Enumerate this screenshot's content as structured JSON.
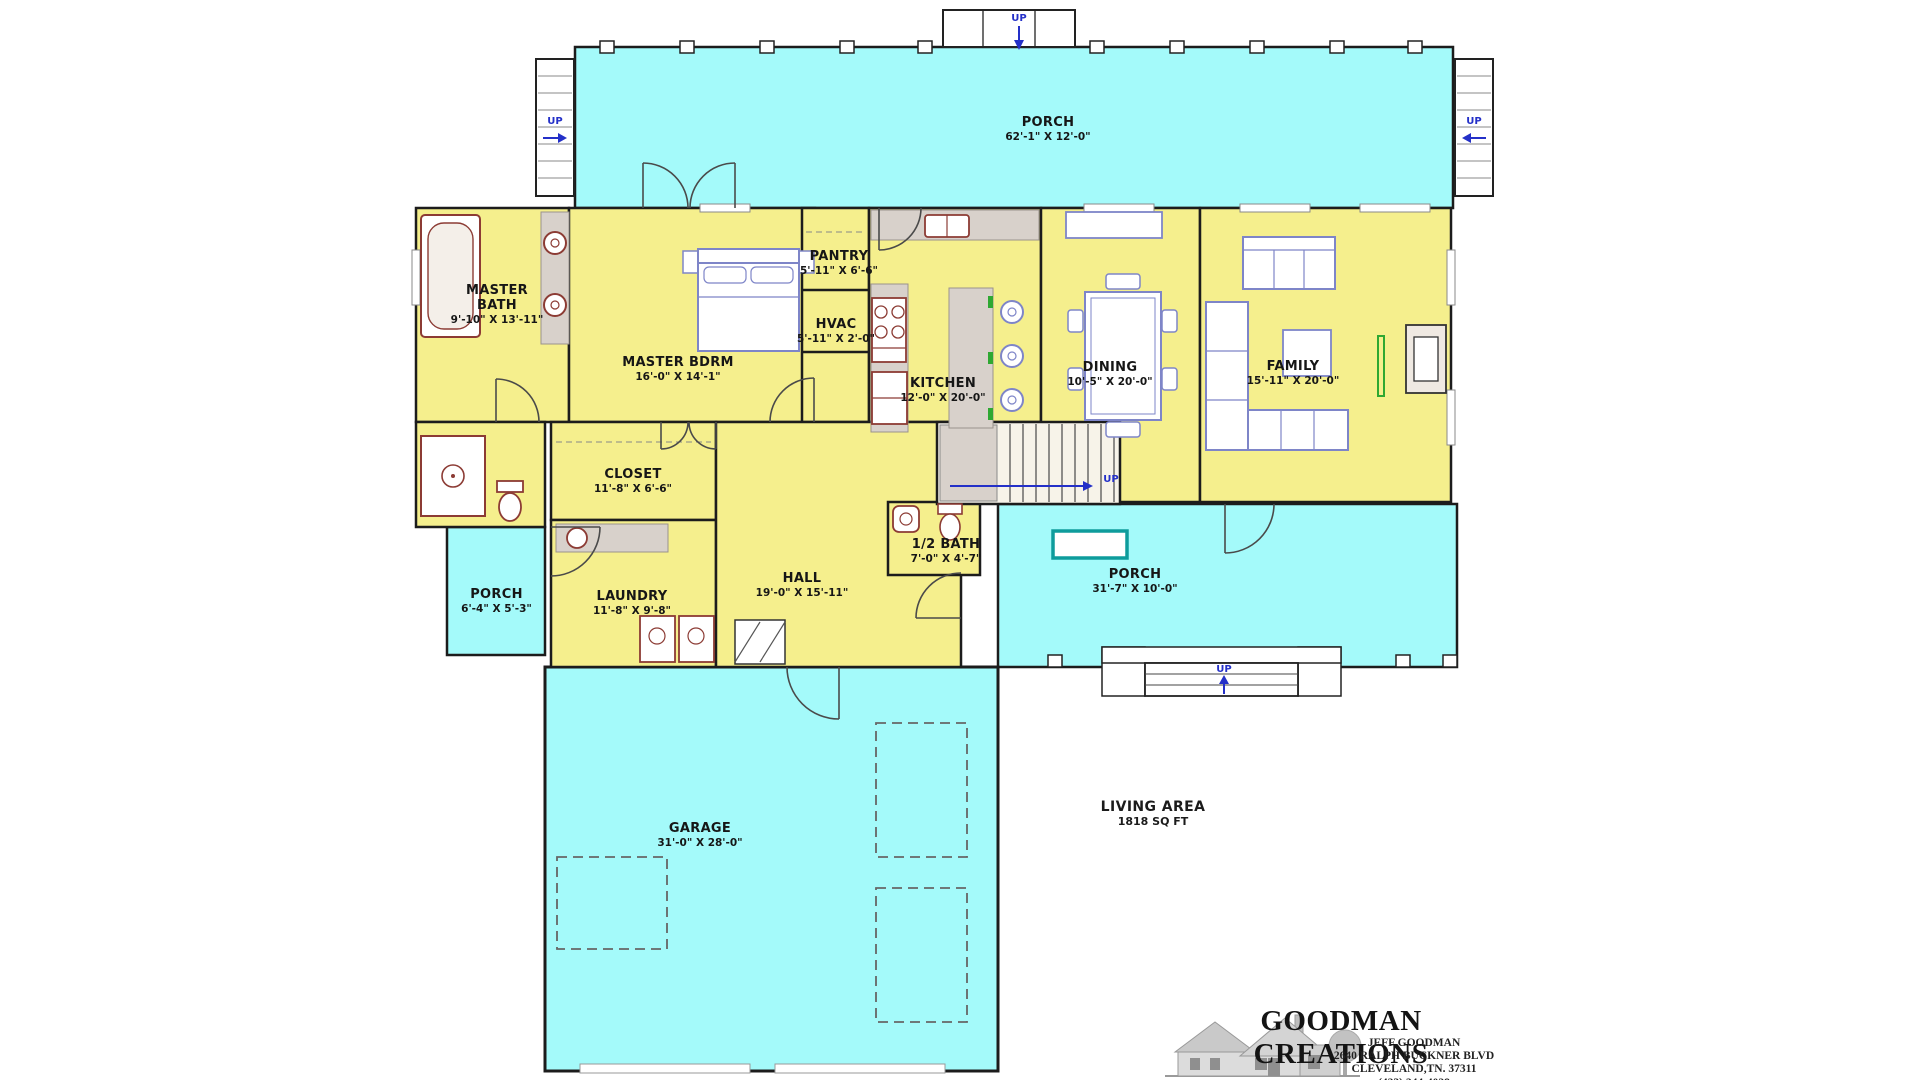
{
  "colors": {
    "porch_fill": "#A4FAFA",
    "room_fill": "#F5EF8D",
    "wall": "#1C1C1C",
    "fixture_maroon": "#8C3B34",
    "furniture_blue": "#7E85C8",
    "counter_gray": "#D8D1CB",
    "accent_green": "#2FA832",
    "accent_teal": "#0E9C9C",
    "annotation_blue": "#2430C8"
  },
  "rooms": {
    "porch_top": {
      "name": "PORCH",
      "dims": "62'-1\" X 12'-0\""
    },
    "master_bath": {
      "name": "MASTER BATH",
      "dims": "9'-10\" X 13'-11\""
    },
    "master_bdrm": {
      "name": "MASTER BDRM",
      "dims": "16'-0\" X 14'-1\""
    },
    "pantry": {
      "name": "PANTRY",
      "dims": "5'-11\" X 6'-6\""
    },
    "hvac": {
      "name": "HVAC",
      "dims": "5'-11\" X 2'-0\""
    },
    "kitchen": {
      "name": "KITCHEN",
      "dims": "12'-0\" X 20'-0\""
    },
    "dining": {
      "name": "DINING",
      "dims": "10'-5\" X 20'-0\""
    },
    "family": {
      "name": "FAMILY",
      "dims": "15'-11\" X 20'-0\""
    },
    "closet": {
      "name": "CLOSET",
      "dims": "11'-8\" X 6'-6\""
    },
    "laundry": {
      "name": "LAUNDRY",
      "dims": "11'-8\" X 9'-8\""
    },
    "hall": {
      "name": "HALL",
      "dims": "19'-0\" X 15'-11\""
    },
    "half_bath": {
      "name": "1/2 BATH",
      "dims": "7'-0\" X 4'-7\""
    },
    "porch_right": {
      "name": "PORCH",
      "dims": "31'-7\" X 10'-0\""
    },
    "porch_left": {
      "name": "PORCH",
      "dims": "6'-4\" X 5'-3\""
    },
    "garage": {
      "name": "GARAGE",
      "dims": "31'-0\" X 28'-0\""
    }
  },
  "annotations": {
    "up": "UP"
  },
  "living_area": {
    "title": "LIVING AREA",
    "value": "1818 SQ FT"
  },
  "logo": {
    "company": "GOODMAN CREATIONS",
    "person": "JEFF GOODMAN",
    "street": "2640 RALPH BUCKNER BLVD",
    "city": "CLEVELAND,TN. 37311",
    "phone": "(423) 244-4028"
  }
}
